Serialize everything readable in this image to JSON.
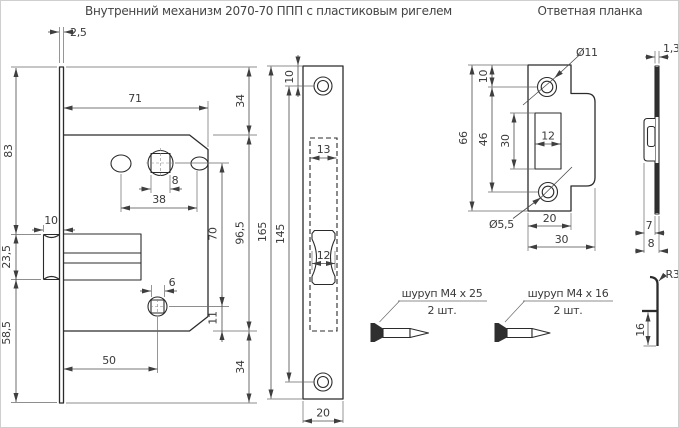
{
  "titles": {
    "mechanism": "Внутренний механизм 2070-70 ППП с пластиковым ригелем",
    "strike": "Ответная планка"
  },
  "lock": {
    "thickness": "2,5",
    "edge_to_latch": "83",
    "latch_height": "23,5",
    "latch_to_edge": "58,5",
    "latch_depth": "10",
    "body_width": "71",
    "top_margin": "34",
    "spindle_size": "8",
    "hole_spacing": "38",
    "spindle_to_key": "70",
    "body_height": "96,5",
    "key_size": "6",
    "key_to_body_edge": "11",
    "key_offset": "50",
    "bottom_margin": "34"
  },
  "plate": {
    "edge_to_hole": "10",
    "cutout_width": "13",
    "bolt_width": "12",
    "height": "165",
    "hole_spacing": "145",
    "width": "20"
  },
  "strike": {
    "hole_diameter": "Ø11",
    "edge_to_hole": "10",
    "height": "66",
    "hole_spacing": "46",
    "cutout_height": "30",
    "cutout_width": "12",
    "small_hole_diameter": "Ø5,5",
    "plate_width": "20",
    "full_width": "30"
  },
  "strike_side": {
    "thickness": "1,3",
    "depth": "7",
    "full_depth": "8",
    "bend_radius": "R3",
    "tongue_height": "16"
  },
  "screws": [
    {
      "label": "шуруп М4 х 25",
      "qty": "2 шт."
    },
    {
      "label": "шуруп М4 х 16",
      "qty": "2 шт."
    }
  ]
}
